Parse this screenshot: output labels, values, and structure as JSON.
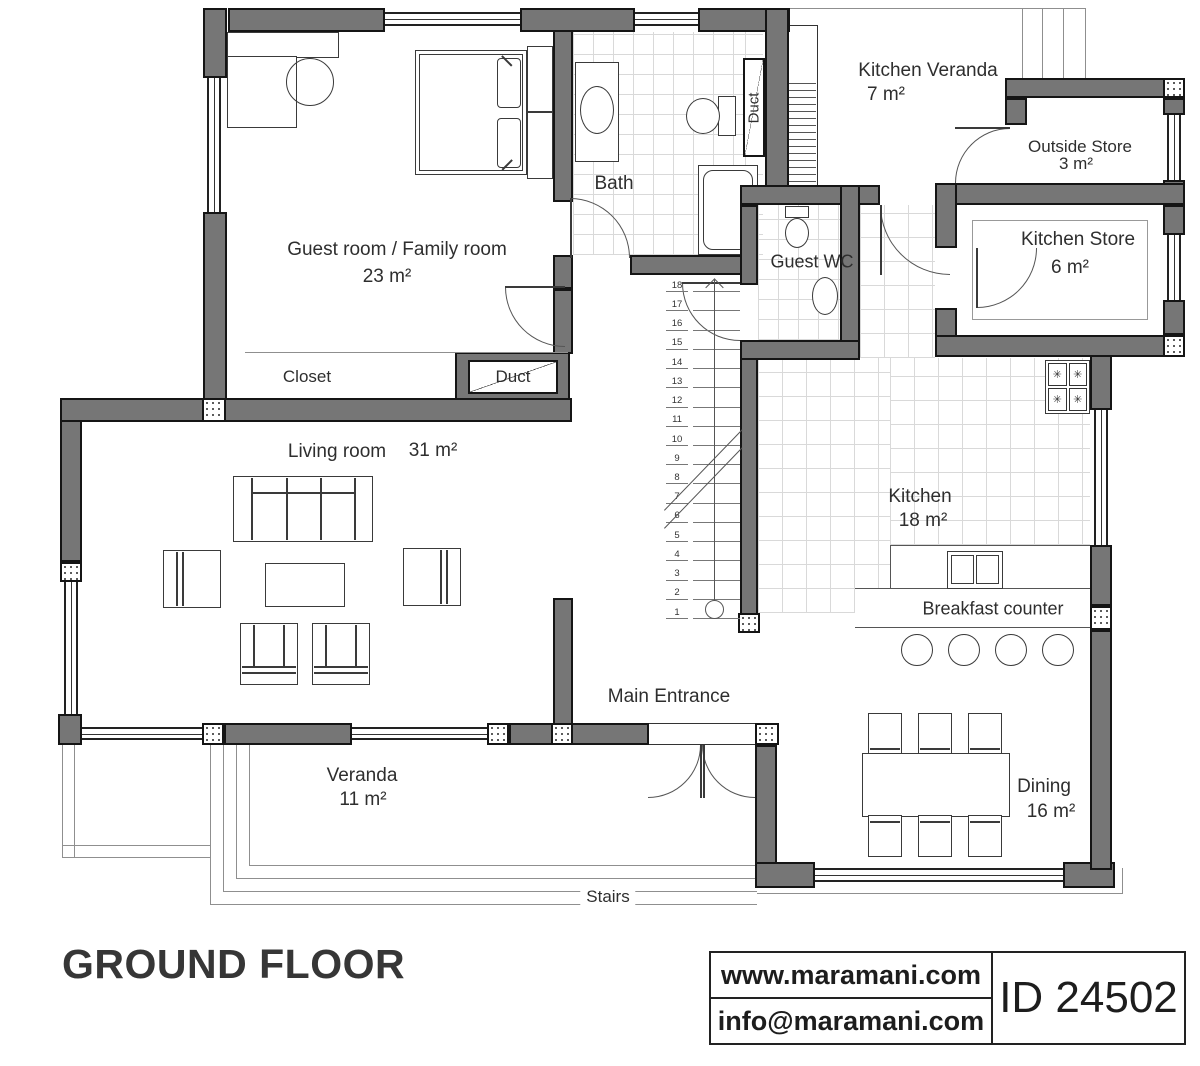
{
  "title": "GROUND FLOOR",
  "footer": {
    "website": "www.maramani.com",
    "email": "info@maramani.com",
    "plan_id": "ID 24502"
  },
  "rooms": {
    "guest_room": {
      "name": "Guest room / Family room",
      "area": "23 m²"
    },
    "bath": {
      "name": "Bath"
    },
    "closet": {
      "name": "Closet"
    },
    "duct_upper": {
      "name": "Duct"
    },
    "duct_lower": {
      "name": "Duct"
    },
    "living_room": {
      "name": "Living room",
      "area": "31 m²"
    },
    "kitchen_veranda": {
      "name": "Kitchen Veranda",
      "area": "7 m²"
    },
    "outside_store": {
      "name": "Outside Store",
      "area": "3 m²"
    },
    "kitchen_store": {
      "name": "Kitchen Store",
      "area": "6 m²"
    },
    "guest_wc": {
      "name": "Guest WC"
    },
    "kitchen": {
      "name": "Kitchen",
      "area": "18 m²"
    },
    "breakfast_counter": {
      "name": "Breakfast counter"
    },
    "main_entrance": {
      "name": "Main Entrance"
    },
    "veranda": {
      "name": "Veranda",
      "area": "11 m²"
    },
    "dining": {
      "name": "Dining",
      "area": "16 m²"
    },
    "stairs": {
      "name": "Stairs"
    }
  },
  "staircase": {
    "steps": [
      1,
      2,
      3,
      4,
      5,
      6,
      7,
      8,
      9,
      10,
      11,
      12,
      13,
      14,
      15,
      16,
      17,
      18
    ]
  },
  "icons": {
    "burner": "✳"
  },
  "colors": {
    "wall": "#767676",
    "line": "#3a3a3a"
  }
}
